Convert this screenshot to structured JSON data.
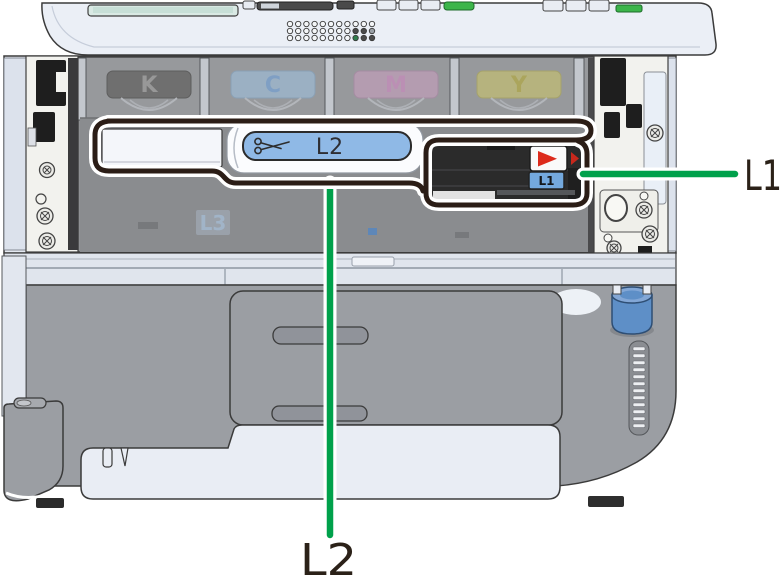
{
  "diagram": {
    "toner_slots": [
      "K",
      "C",
      "M",
      "Y"
    ],
    "part_labels": {
      "strip_label": "L2",
      "unit_label": "L1",
      "interior_label": "L3"
    },
    "callouts": [
      {
        "text": "L1",
        "direction": "right"
      },
      {
        "text": "L2",
        "direction": "down"
      }
    ],
    "icons": [
      "scissors-icon",
      "warning-triangle-icon"
    ],
    "colors": {
      "leader_green": "#00A14B",
      "outline_dark": "#2B1D16",
      "label_blue": "#8FB9E6",
      "warning_red": "#DD2B1C",
      "knob_blue": "#5E8FC7",
      "body_light": "#E4E9F1",
      "body_gray": "#9B9EA3",
      "interior_gray": "#8F9194",
      "callout_text": "#2B2118",
      "toner_label_colors": {
        "K": "#6F6F6F",
        "C": "#9BB0C3",
        "M": "#B49CB0",
        "Y": "#B6B37E"
      }
    }
  }
}
